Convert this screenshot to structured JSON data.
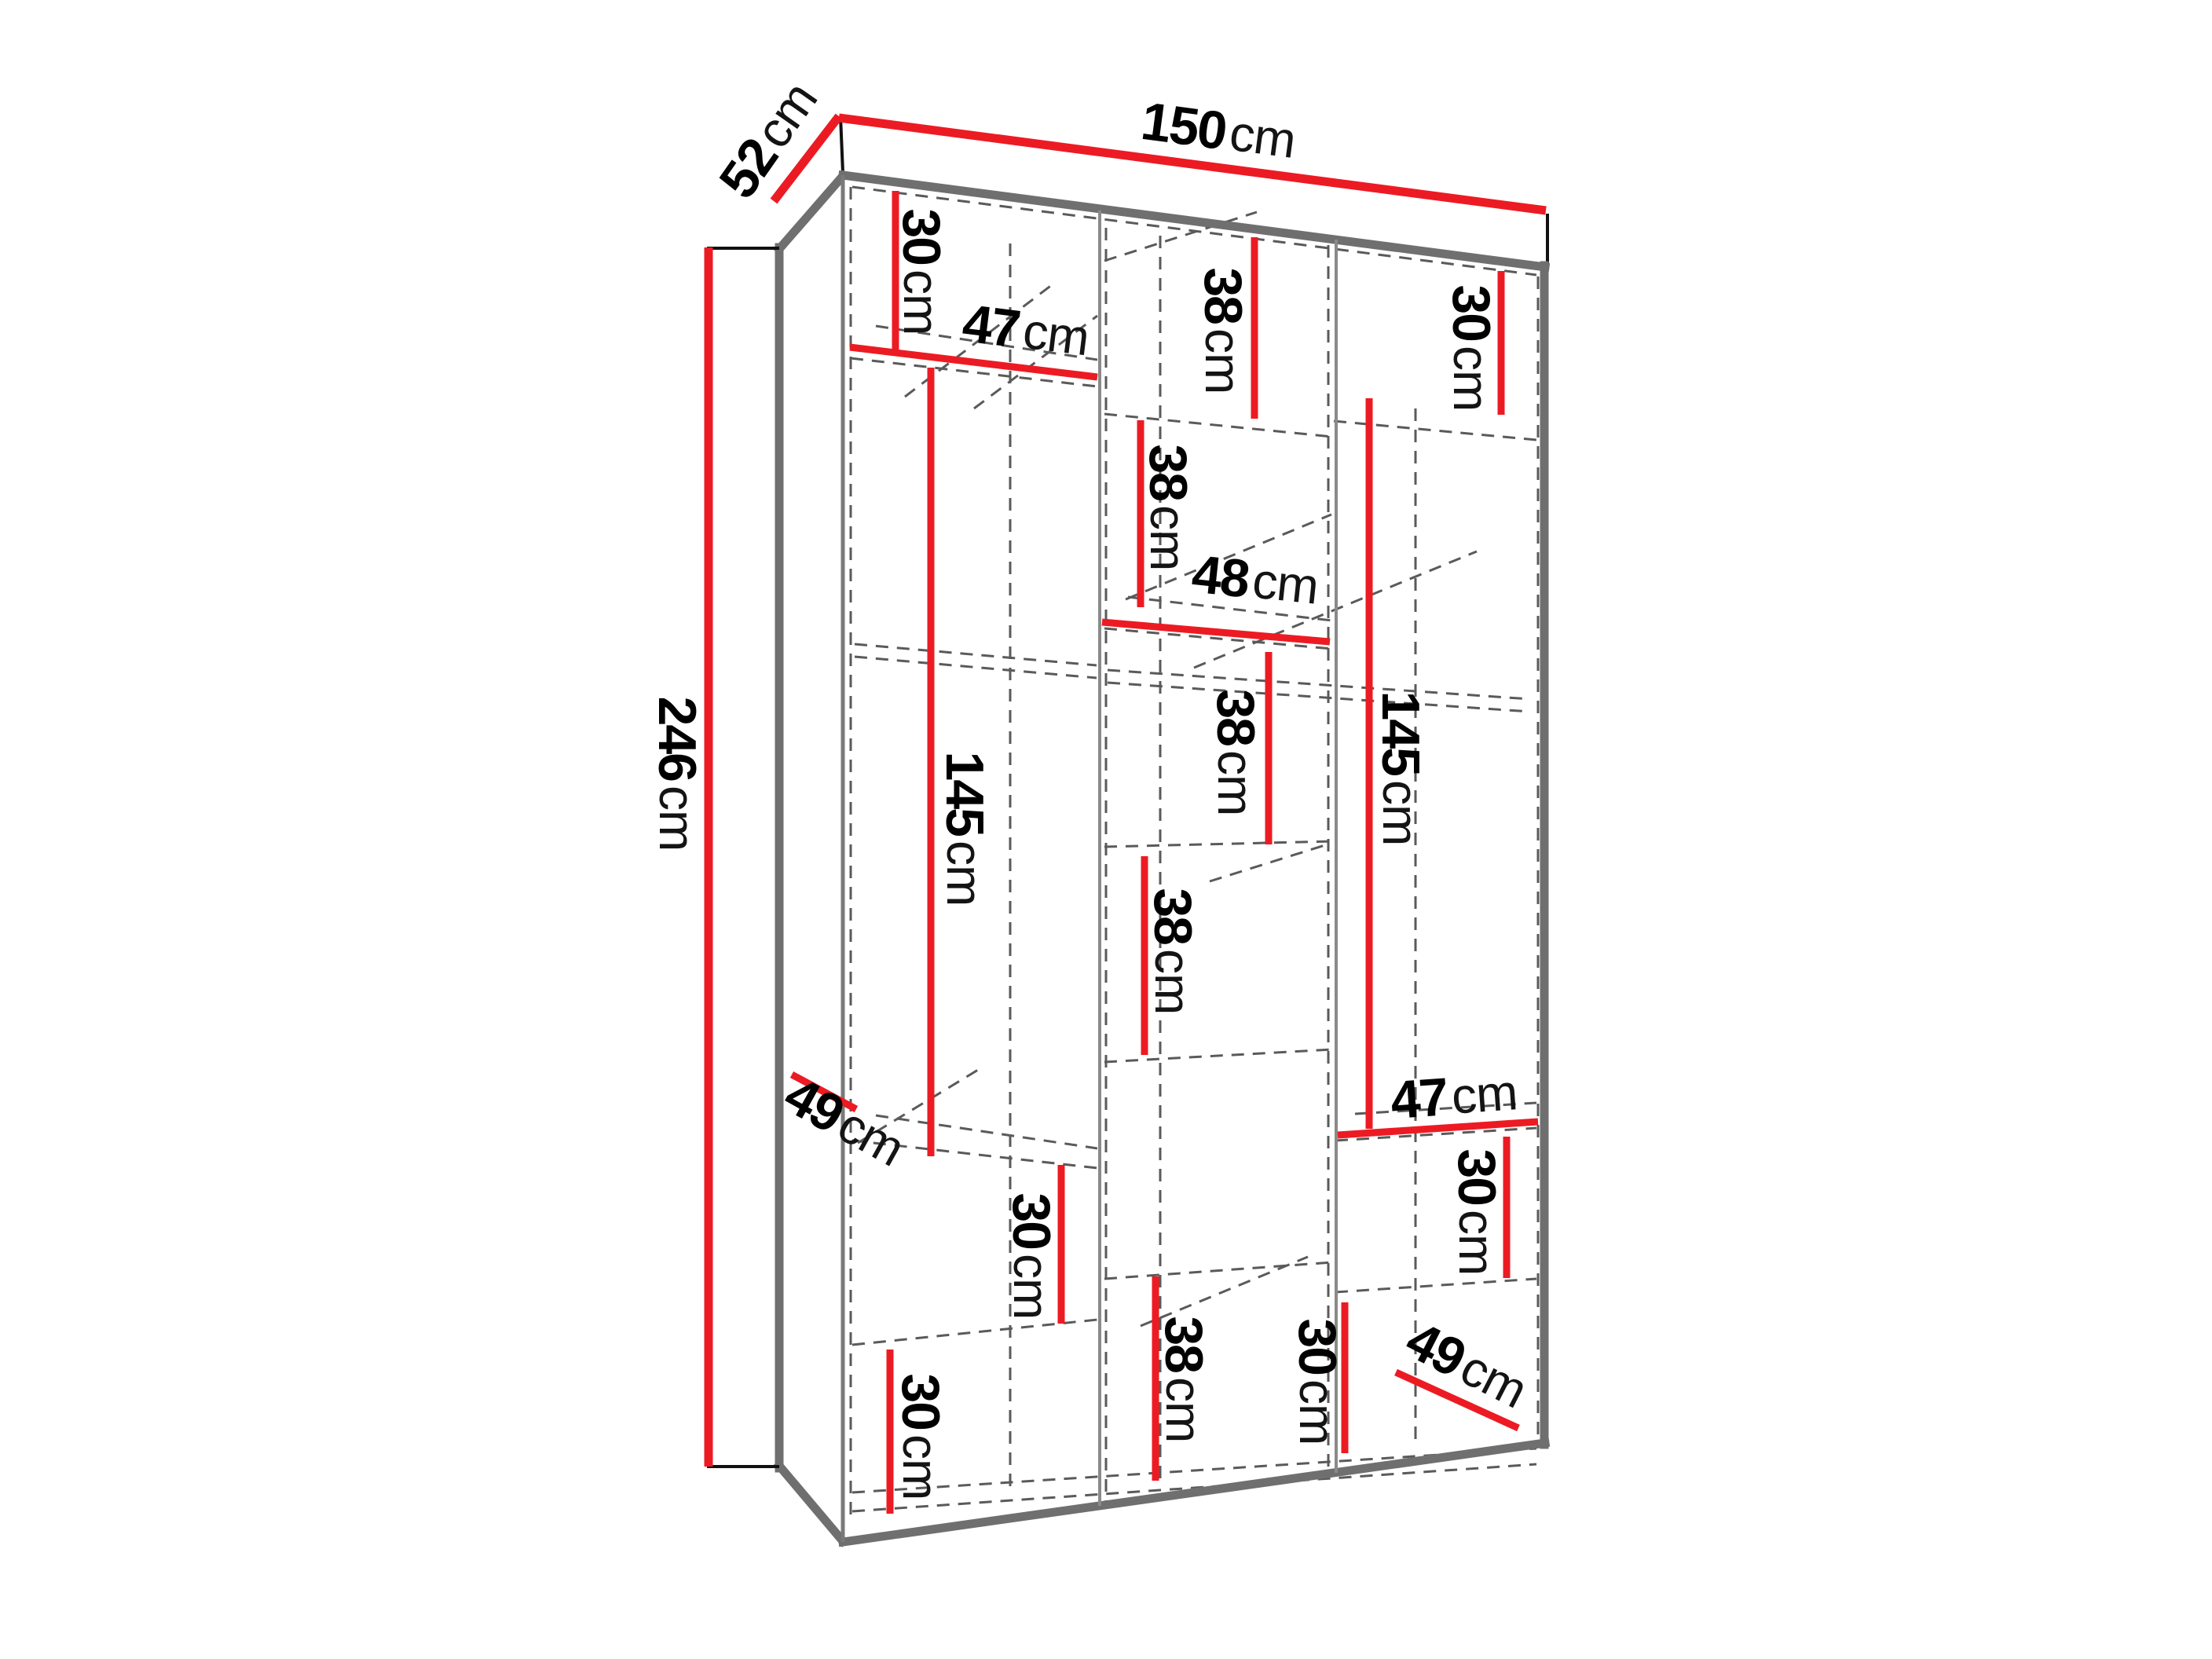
{
  "diagram": {
    "type": "furniture-dimension-diagram",
    "subject": "three-section wardrobe interior with shelf and rail dimensions",
    "background": "#ffffff",
    "colors": {
      "dimension_red": "#EC1B23",
      "carcass_gray": "#6f6f6f",
      "hidden_line_gray": "#5a5a5a",
      "label_black": "#000000"
    },
    "overall": {
      "width": "150cm",
      "depth": "52cm",
      "height": "246cm"
    },
    "dims": [
      {
        "name": "overall-width",
        "value": "150",
        "unit": "cm",
        "text": "150cm"
      },
      {
        "name": "overall-depth",
        "value": "52",
        "unit": "cm",
        "text": "52cm"
      },
      {
        "name": "overall-height",
        "value": "246",
        "unit": "cm",
        "text": "246cm"
      },
      {
        "name": "left-top-section",
        "value": "30",
        "unit": "cm",
        "text": "30cm"
      },
      {
        "name": "left-shelf-width",
        "value": "47",
        "unit": "cm",
        "text": "47cm"
      },
      {
        "name": "middle-top-section",
        "value": "38",
        "unit": "cm",
        "text": "38cm"
      },
      {
        "name": "right-top-section",
        "value": "30",
        "unit": "cm",
        "text": "30cm"
      },
      {
        "name": "middle-section-2",
        "value": "38",
        "unit": "cm",
        "text": "38cm"
      },
      {
        "name": "middle-shelf-width",
        "value": "48",
        "unit": "cm",
        "text": "48cm"
      },
      {
        "name": "left-hanging-space",
        "value": "145",
        "unit": "cm",
        "text": "145cm"
      },
      {
        "name": "right-hanging-space",
        "value": "145",
        "unit": "cm",
        "text": "145cm"
      },
      {
        "name": "middle-section-3",
        "value": "38",
        "unit": "cm",
        "text": "38cm"
      },
      {
        "name": "middle-section-4",
        "value": "38",
        "unit": "cm",
        "text": "38cm"
      },
      {
        "name": "left-shelf-depth",
        "value": "49",
        "unit": "cm",
        "text": "49cm"
      },
      {
        "name": "left-lower-section",
        "value": "30",
        "unit": "cm",
        "text": "30cm"
      },
      {
        "name": "right-shelf-width",
        "value": "47",
        "unit": "cm",
        "text": "47cm"
      },
      {
        "name": "right-lower-section",
        "value": "30",
        "unit": "cm",
        "text": "30cm"
      },
      {
        "name": "middle-bottom-section",
        "value": "38",
        "unit": "cm",
        "text": "38cm"
      },
      {
        "name": "right-bottom-section",
        "value": "30",
        "unit": "cm",
        "text": "30cm"
      },
      {
        "name": "left-bottom-section",
        "value": "30",
        "unit": "cm",
        "text": "30cm"
      },
      {
        "name": "right-shelf-depth",
        "value": "49",
        "unit": "cm",
        "text": "49cm"
      }
    ]
  }
}
